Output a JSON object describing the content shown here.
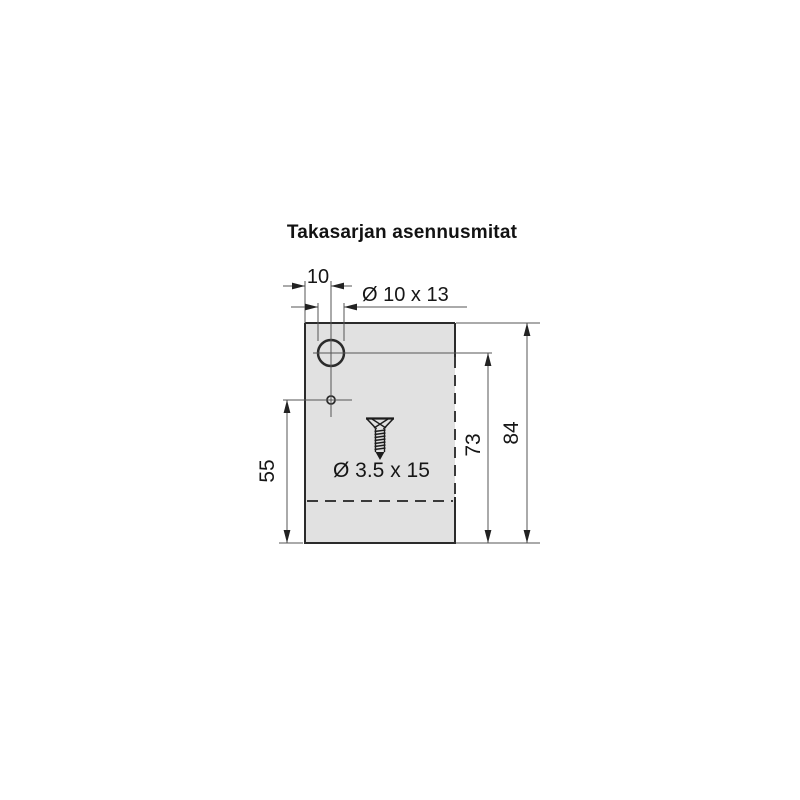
{
  "title": "Takasarjan asennusmitat",
  "drawing": {
    "labels": {
      "top_offset": "10",
      "hole": "Ø 10 x 13",
      "left_height": "55",
      "hole_height": "73",
      "total_height": "84",
      "screw": "Ø 3.5 x 15"
    },
    "icons": {
      "screw_icon": "countersunk-screw-side-view"
    },
    "colors": {
      "panel_fill": "#e1e1e1",
      "outline": "#2b2b2b",
      "dimension_line": "#555555",
      "arrow_fill": "#222222",
      "text": "#161616",
      "background": "#ffffff"
    }
  }
}
